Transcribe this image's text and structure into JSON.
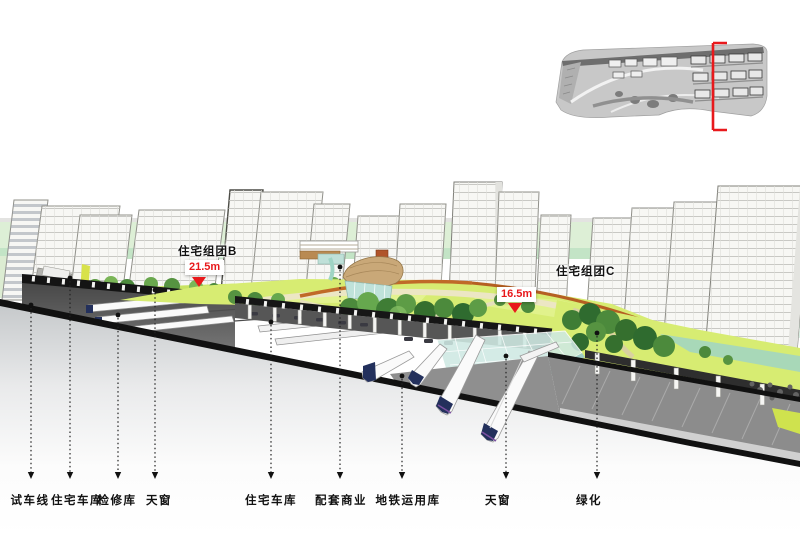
{
  "figure": {
    "type": "sectional-perspective-rendering",
    "annotations": {
      "cluster_b": {
        "label": "住宅组团B",
        "elevation": "21.5m"
      },
      "cluster_c": {
        "label": "住宅组团C",
        "elevation": "16.5m"
      }
    },
    "callouts": [
      {
        "label": "试车线",
        "x": 31,
        "top": 305,
        "lx": 30
      },
      {
        "label": "住宅车库",
        "x": 70,
        "top": 278,
        "lx": 77
      },
      {
        "label": "检修库",
        "x": 118,
        "top": 315,
        "lx": 117
      },
      {
        "label": "天窗",
        "x": 155,
        "top": 290,
        "lx": 159
      },
      {
        "label": "住宅车库",
        "x": 271,
        "top": 322,
        "lx": 271
      },
      {
        "label": "配套商业",
        "x": 340,
        "top": 267,
        "lx": 341
      },
      {
        "label": "地铁运用库",
        "x": 402,
        "top": 376,
        "lx": 408
      },
      {
        "label": "天窗",
        "x": 506,
        "top": 356,
        "lx": 498
      },
      {
        "label": "绿化",
        "x": 597,
        "top": 333,
        "lx": 589
      }
    ],
    "colors": {
      "accent_red": "#e8191c",
      "lawn": "#d7ec72",
      "tree_dark": "#3f7d35",
      "glass_skylight": "#cfe9e3",
      "structure_black": "#151515",
      "label_text": "#111111"
    }
  }
}
